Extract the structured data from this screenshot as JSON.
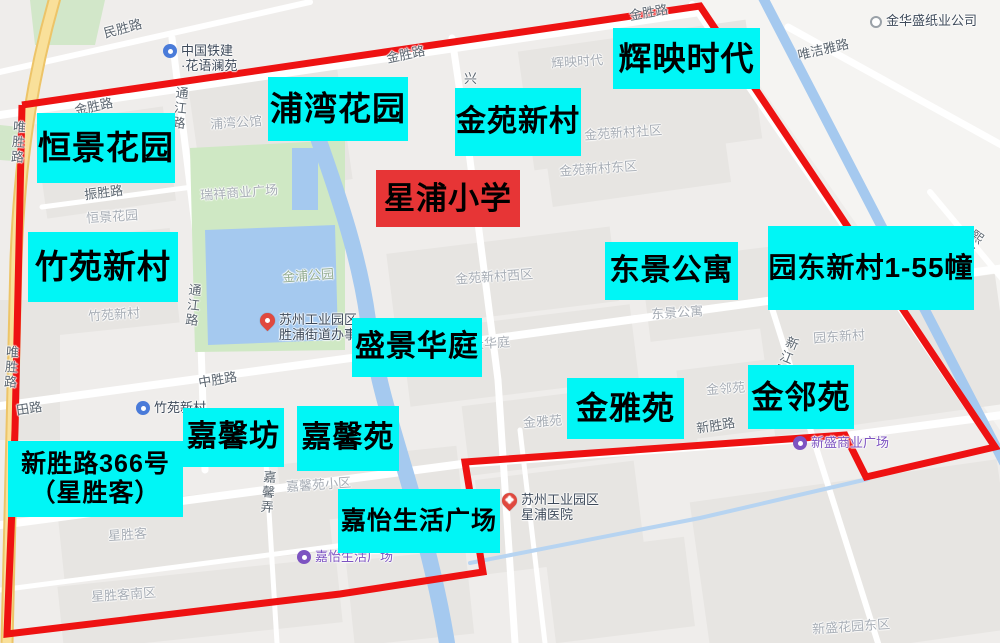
{
  "map": {
    "colors": {
      "annotation_cyan": "#00f6f6",
      "annotation_red": "#e73536",
      "boundary_red": "#ee1212",
      "area_label_gray": "#a7adb5",
      "road_label_gray": "#5c6670",
      "park_label_green": "#94ad92",
      "poi_text_dark": "#3e4a5a",
      "poi_text_purple": "#7d53c1",
      "water_blue": "#a5c9ef"
    },
    "boundary": {
      "points": "22,105 700,6 995,447 866,477 845,435 465,462 483,572 340,594 7,634 15,430 22,105"
    },
    "school_label": {
      "text": "星浦小学",
      "x": 376,
      "y": 170,
      "w": 144,
      "h": 57,
      "fs": 31
    },
    "community_labels": [
      {
        "text": "恒景花园",
        "x": 37,
        "y": 113,
        "w": 138,
        "h": 70,
        "fs": 33
      },
      {
        "text": "浦湾花园",
        "x": 268,
        "y": 77,
        "w": 140,
        "h": 64,
        "fs": 33
      },
      {
        "text": "金苑新村",
        "x": 455,
        "y": 88,
        "w": 126,
        "h": 68,
        "fs": 30
      },
      {
        "text": "辉映时代",
        "x": 613,
        "y": 28,
        "w": 147,
        "h": 61,
        "fs": 33
      },
      {
        "text": "竹苑新村",
        "x": 28,
        "y": 232,
        "w": 150,
        "h": 70,
        "fs": 33
      },
      {
        "text": "东景公寓",
        "x": 605,
        "y": 242,
        "w": 133,
        "h": 58,
        "fs": 30
      },
      {
        "text": "园东新村1-55幢",
        "x": 768,
        "y": 226,
        "w": 206,
        "h": 84,
        "fs": 28
      },
      {
        "text": "盛景华庭",
        "x": 352,
        "y": 318,
        "w": 130,
        "h": 59,
        "fs": 30
      },
      {
        "text": "金雅苑",
        "x": 567,
        "y": 378,
        "w": 117,
        "h": 61,
        "fs": 32
      },
      {
        "text": "金邻苑",
        "x": 748,
        "y": 365,
        "w": 106,
        "h": 64,
        "fs": 32
      },
      {
        "text": "嘉馨坊",
        "x": 183,
        "y": 408,
        "w": 101,
        "h": 59,
        "fs": 30
      },
      {
        "text": "嘉馨苑",
        "x": 297,
        "y": 406,
        "w": 102,
        "h": 65,
        "fs": 30
      },
      {
        "text": "新胜路366号（星胜客）",
        "lines": [
          "新胜路366号",
          "（星胜客）"
        ],
        "x": 8,
        "y": 441,
        "w": 175,
        "h": 76,
        "fs": 25
      },
      {
        "text": "嘉怡生活广场",
        "x": 338,
        "y": 489,
        "w": 162,
        "h": 64,
        "fs": 25
      }
    ],
    "area_labels": [
      {
        "text": "浦湾公馆",
        "x": 210,
        "y": 112
      },
      {
        "text": "瑞祥商业广场",
        "x": 200,
        "y": 182
      },
      {
        "text": "恒景花园",
        "x": 86,
        "y": 206
      },
      {
        "text": "竹苑新村",
        "x": 88,
        "y": 304
      },
      {
        "text": "金浦公园",
        "x": 282,
        "y": 265,
        "green": true
      },
      {
        "text": "辉映时代",
        "x": 551,
        "y": 51
      },
      {
        "text": "金苑新村社区",
        "x": 584,
        "y": 122
      },
      {
        "text": "金苑新村东区",
        "x": 559,
        "y": 158
      },
      {
        "text": "金苑新村西区",
        "x": 455,
        "y": 266
      },
      {
        "text": "盛景华庭",
        "x": 458,
        "y": 333
      },
      {
        "text": "东景公寓",
        "x": 651,
        "y": 302
      },
      {
        "text": "园东新村",
        "x": 813,
        "y": 326
      },
      {
        "text": "金邻苑",
        "x": 706,
        "y": 378
      },
      {
        "text": "金雅苑",
        "x": 523,
        "y": 411
      },
      {
        "text": "星胜客",
        "x": 108,
        "y": 524
      },
      {
        "text": "星胜客南区",
        "x": 91,
        "y": 584
      },
      {
        "text": "嘉馨苑小区",
        "x": 286,
        "y": 474
      },
      {
        "text": "新盛花园东区",
        "x": 812,
        "y": 616
      }
    ],
    "road_labels": [
      {
        "text": "民胜路",
        "x": 103,
        "y": 18,
        "rot": -15
      },
      {
        "text": "金胜路",
        "x": 74,
        "y": 96,
        "rot": -12
      },
      {
        "text": "金胜路",
        "x": 386,
        "y": 44,
        "rot": -12
      },
      {
        "text": "金胜路",
        "x": 629,
        "y": 2,
        "rot": -10
      },
      {
        "text": "通江路",
        "x": 170,
        "y": 86,
        "vert": true,
        "rot": 6
      },
      {
        "text": "通江路",
        "x": 183,
        "y": 283,
        "vert": true,
        "rot": 6
      },
      {
        "text": "唯胜路",
        "x": 8,
        "y": 120,
        "vert": true,
        "rot": 4
      },
      {
        "text": "唯胜路",
        "x": 1,
        "y": 345,
        "vert": true,
        "rot": 4
      },
      {
        "text": "中胜路",
        "x": 198,
        "y": 369,
        "rot": -9
      },
      {
        "text": "田路",
        "x": 16,
        "y": 398,
        "rot": -9
      },
      {
        "text": "唯洁雅路",
        "x": 797,
        "y": 39,
        "rot": -13
      },
      {
        "text": "兴",
        "x": 464,
        "y": 68,
        "rot": 0
      },
      {
        "text": "新江路",
        "x": 776,
        "y": 335,
        "vert": true,
        "rot": 22
      },
      {
        "text": "新胜路",
        "x": 696,
        "y": 415,
        "rot": -9
      },
      {
        "text": "熙路",
        "x": 962,
        "y": 228,
        "vert": true,
        "rot": 35
      },
      {
        "text": "嘉馨弄",
        "x": 258,
        "y": 470,
        "vert": true,
        "rot": 5
      },
      {
        "text": "振胜路",
        "x": 84,
        "y": 182,
        "rot": -7
      }
    ],
    "pois": [
      {
        "type": "blue-circle",
        "lines": [
          "中国铁建",
          "·花语澜苑"
        ],
        "x": 163,
        "y": 43,
        "purple": false
      },
      {
        "type": "gray-dot",
        "lines": [
          "金华盛纸业公司"
        ],
        "x": 870,
        "y": 13,
        "purple": false
      },
      {
        "type": "red-pin",
        "lines": [
          "苏州工业园区",
          "胜浦街道办事处"
        ],
        "x": 260,
        "y": 312,
        "purple": false
      },
      {
        "type": "blue-circle",
        "lines": [
          "竹苑新村"
        ],
        "x": 136,
        "y": 400,
        "purple": false
      },
      {
        "type": "purple-circle",
        "lines": [
          "嘉怡生活广场"
        ],
        "x": 297,
        "y": 549,
        "purple": true
      },
      {
        "type": "red-cross-pin",
        "lines": [
          "苏州工业园区",
          "星浦医院"
        ],
        "x": 502,
        "y": 492,
        "purple": false
      },
      {
        "type": "purple-circle",
        "lines": [
          "新盛商业广场"
        ],
        "x": 793,
        "y": 435,
        "purple": true
      }
    ]
  }
}
